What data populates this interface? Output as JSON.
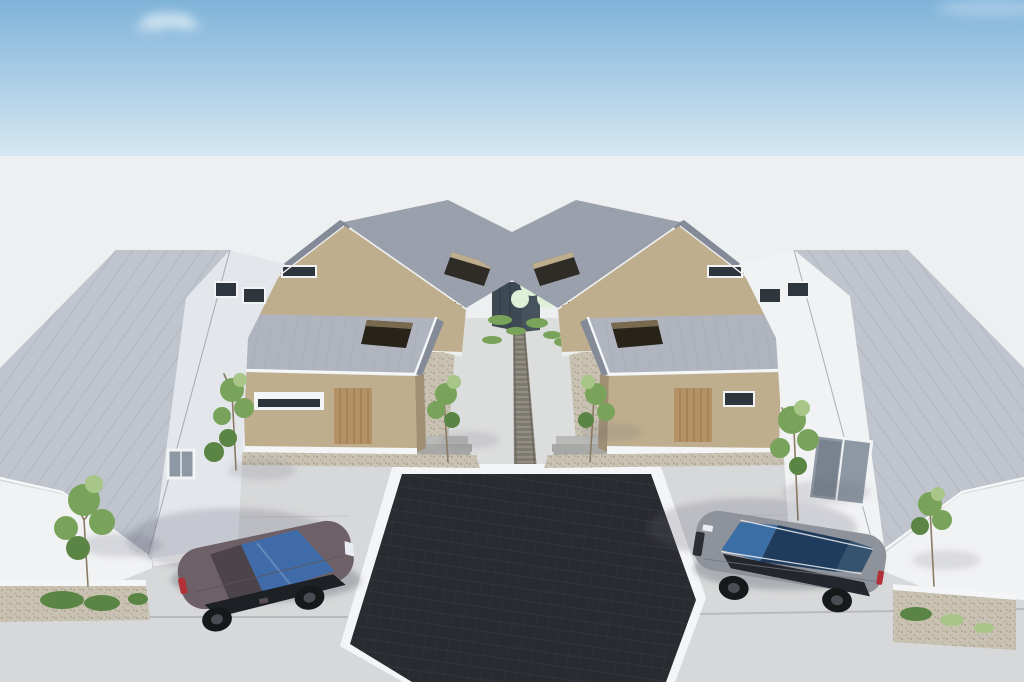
{
  "scene": {
    "title": "Aerial 3D architectural rendering of a symmetric residential compound",
    "view": "bird's-eye, looking north at two mirrored house clusters",
    "elements": [
      {
        "id": "white-house-left",
        "walls": "white stucco",
        "roof": "gray standing-seam gable",
        "windows": "two small gable windows, one square window"
      },
      {
        "id": "white-house-right",
        "walls": "white stucco",
        "roof": "gray standing-seam gable",
        "windows": "two small gable windows, one tall sliding window"
      },
      {
        "id": "beige-house-left",
        "walls": "beige stucco",
        "roof": "gray gable with rectangular roof opening"
      },
      {
        "id": "beige-house-right",
        "walls": "beige stucco",
        "roof": "gray gable with rectangular roof opening"
      },
      {
        "id": "annex-left",
        "walls": "beige stucco",
        "roof": "flat metal roof with courtyard cutout",
        "door": "vertical wood-slat entry door"
      },
      {
        "id": "annex-right",
        "walls": "beige stucco",
        "roof": "flat metal roof with courtyard cutout",
        "door": "vertical wood-slat entry door"
      },
      {
        "id": "suv-left",
        "type": "coupe SUV",
        "facing": "right"
      },
      {
        "id": "suv-right",
        "type": "SUV with roof rails",
        "facing": "left"
      },
      {
        "id": "central-plaza",
        "type": "dark charcoal square court with white tile border"
      },
      {
        "id": "central-walkway",
        "type": "concrete path with brick accent strip and planting beds"
      },
      {
        "id": "landscaping",
        "type": "ornamental trees, shrubs and gravel beds"
      }
    ]
  },
  "colors": {
    "sky_top": "#7fb3d9",
    "sky_horizon": "#d6e8f2",
    "cloud": "#ffffff",
    "ground": "#edeff1",
    "concrete": "#d7d8d9",
    "walkway": "#dcdddd",
    "curb": "#f4f5f6",
    "plaza": "#2a2b30",
    "roof_light": "#bfc4cd",
    "roof_mid": "#9aa0ac",
    "roof_dark": "#848a97",
    "roof_flat": "#afb4be",
    "wall_white": "#f1f2f4",
    "wall_white_shade": "#e3e6eb",
    "wall_tan": "#bfae8e",
    "wall_tan_shade": "#a08f74",
    "wall_tan_dark": "#79694f",
    "door_wood": "#b59166",
    "glass": "#8d98a4",
    "glass_dark": "#2f353c",
    "gravel": "#c9c2b3",
    "paver": "#a8a8a6",
    "paver_dark": "#7d7a72",
    "paver_light": "#b9b9b7",
    "back_structure": "#3e4a53",
    "foliage": "#79a35a",
    "foliage_dark": "#5a8544",
    "foliage_light": "#a7c687",
    "blossom": "#dff0d8",
    "trunk": "#8a7a63",
    "shadow": "#5c616d",
    "taillight": "#b23038",
    "headlight": "#e9edf3",
    "car_left_body": "#6d6067",
    "car_left_glass": "#3f6ca8",
    "car_left_trim": "#1d2126",
    "car_right_body": "#8e929a",
    "car_right_glass": "#3c6ea6",
    "car_right_sunroof": "#1f3c5c",
    "car_right_trim": "#23272d"
  }
}
